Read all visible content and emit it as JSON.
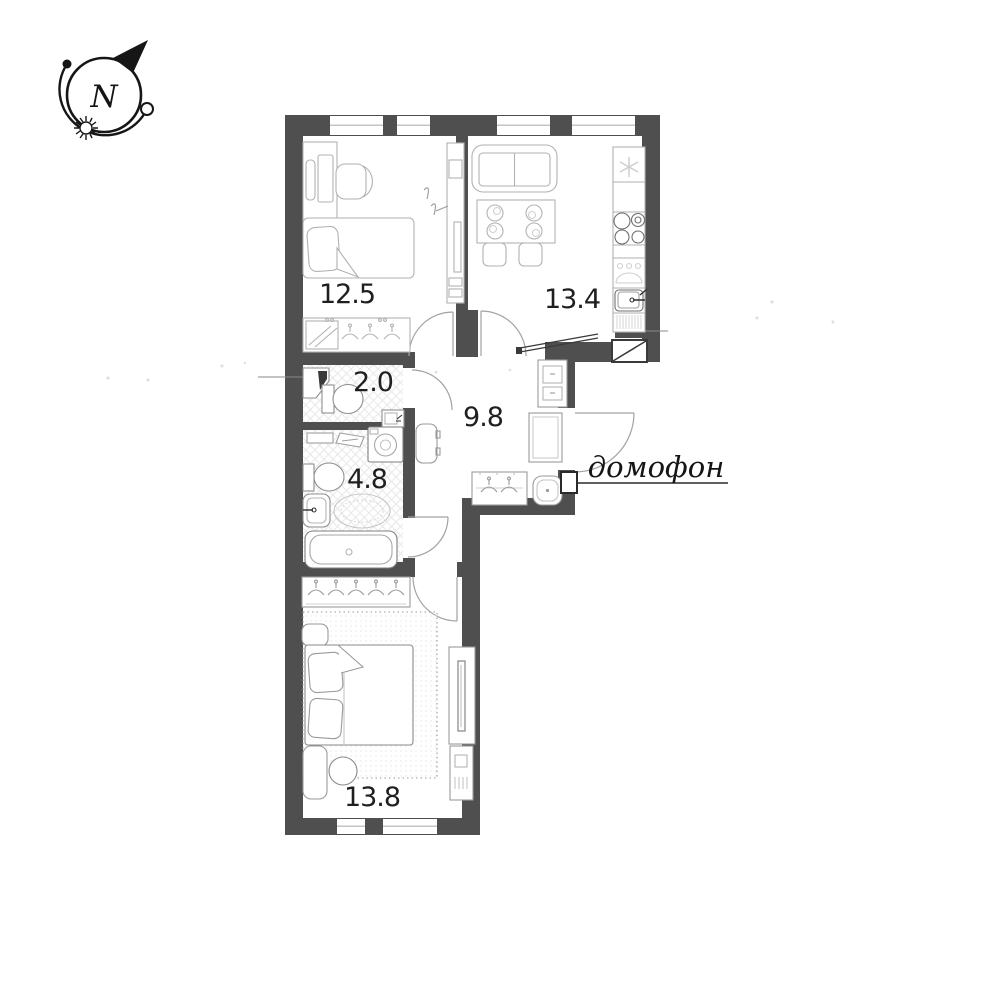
{
  "compass": {
    "label": "N"
  },
  "rooms": {
    "bedroom_top": {
      "area": "12.5"
    },
    "kitchen": {
      "area": "13.4"
    },
    "wc": {
      "area": "2.0"
    },
    "hallway": {
      "area": "9.8"
    },
    "bathroom": {
      "area": "4.8"
    },
    "bedroom_bottom": {
      "area": "13.8"
    }
  },
  "labels": {
    "intercom": "домофон"
  },
  "colors": {
    "wall": "#4f4f4f",
    "furniture_line": "#b2b2b2",
    "fixture_line": "#8a8a8a",
    "dark_line": "#333333",
    "text": "#1f1f1f",
    "background": "#ffffff"
  }
}
